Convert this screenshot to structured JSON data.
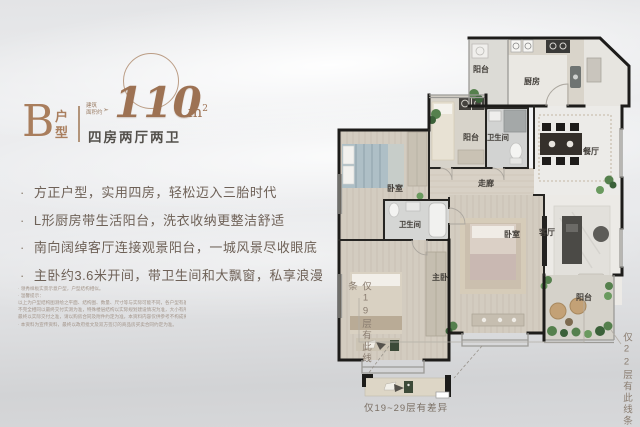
{
  "header": {
    "unit_letter": "B",
    "unit_type_label": "户型",
    "area_prefix_line1": "建筑",
    "area_prefix_line2": "面积约",
    "area_arrow_glyph": "➣",
    "area_value": "110",
    "area_unit": "m",
    "area_unit_exp": "2",
    "layout_summary": "四房两厅两卫"
  },
  "ui": {
    "bullet": "·"
  },
  "features": [
    "方正户型，实用四房，轻松迈入三胎时代",
    "L形厨房带生活阳台，洗衣收纳更整洁舒适",
    "南向阔绰客厅连接观景阳台，一城风景尽收眼底",
    "主卧约3.6米开间，带卫生间和大飘窗，私享浪漫"
  ],
  "disclaimer": {
    "lines": [
      "· 领秀样板实景示意户型，户型结构相似。",
      "· 温馨提示：",
      "以上为户型结构图测绘之平面、结构图、数量、尺寸等与实际可能不同，各户型有差异存在，面积与尺寸",
      "不完全相同以最终交付实测为准，特殊楼层结构以实际规划建设情况为准，大小有所差异。",
      "最终以实际交付之准，请以购房合同及附件约定为准，本资料内容仅供参考不构成要约或承诺。",
      "· 本资料为宣传资料，最终以政府批文及双方签订的商品房买卖合同约定为准。"
    ]
  },
  "floorplan": {
    "labels": {
      "balcony_top": "阳台",
      "kitchen": "厨房",
      "laundry_balcony": "阳台",
      "bathroom": "卫生间",
      "dining": "餐厅",
      "bedroom_left": "卧室",
      "corridor": "走廊",
      "master_bathroom": "卫生间",
      "bedroom_mid": "卧室",
      "living": "客厅",
      "master_bedroom": "主卧",
      "balcony_bottom": "阳台"
    },
    "annotations": {
      "floor19": "仅19层有此线条",
      "floor22": "仅22层有此线条",
      "floors_19_29": "仅19~29层有差异"
    }
  },
  "colors": {
    "copper_accent": "#a97e5d",
    "headline_text": "#53504b",
    "feature_text": "#6e6157",
    "wall": "#1d1c1a",
    "greenery": "#55804d"
  }
}
